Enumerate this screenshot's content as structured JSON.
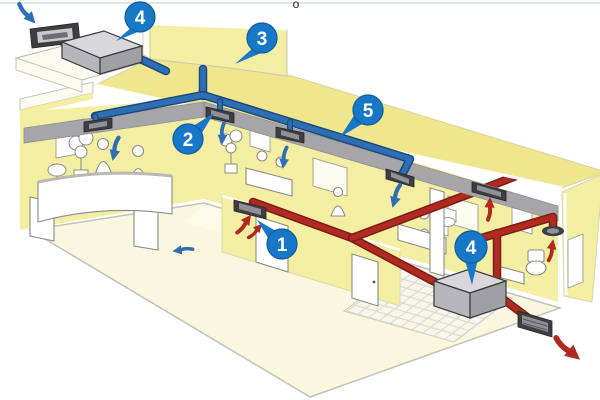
{
  "page": {
    "background": "#ffffff",
    "top_rule_color": "#e0e6e0",
    "stray_glyph": "o"
  },
  "diagram": {
    "kind": "building-ventilation-isometric-cutaway",
    "badges": [
      {
        "label": "4",
        "target": "supply-air-handling-unit"
      },
      {
        "label": "3",
        "target": "roof-void"
      },
      {
        "label": "2",
        "target": "ceiling-supply-diffuser"
      },
      {
        "label": "5",
        "target": "supply-duct-run"
      },
      {
        "label": "1",
        "target": "extract-grille"
      },
      {
        "label": "4",
        "target": "extract-fan-unit"
      }
    ],
    "colors": {
      "supply-blue": "#2e6fb4",
      "supply-blue-dark": "#1a4a7c",
      "extract-red": "#b02a22",
      "extract-red-dark": "#7d1b14",
      "badge-blue": "#1878c8",
      "badge-blue-dark": "#0e5c9e",
      "wall-yellow": "#f4eea2",
      "wall-yellow-deep": "#efe68d",
      "floor-cream": "#faf7de",
      "corridor-cream": "#fcfae9",
      "ceiling-grey": "#a6a6a8",
      "unit-grey-top": "#d8d8da",
      "unit-grey-front": "#b7b7bb",
      "unit-grey-side": "#a0a0a4",
      "vent-dark": "#3e3e42",
      "vent-inner": "#919195",
      "tile-floor": "#f6f6ee",
      "white": "#ffffff"
    },
    "airflow": {
      "supply_color": "#2e6fb4",
      "extract_color": "#b02a22",
      "supply_arrow_count": 6,
      "extract_arrow_count": 5
    }
  }
}
